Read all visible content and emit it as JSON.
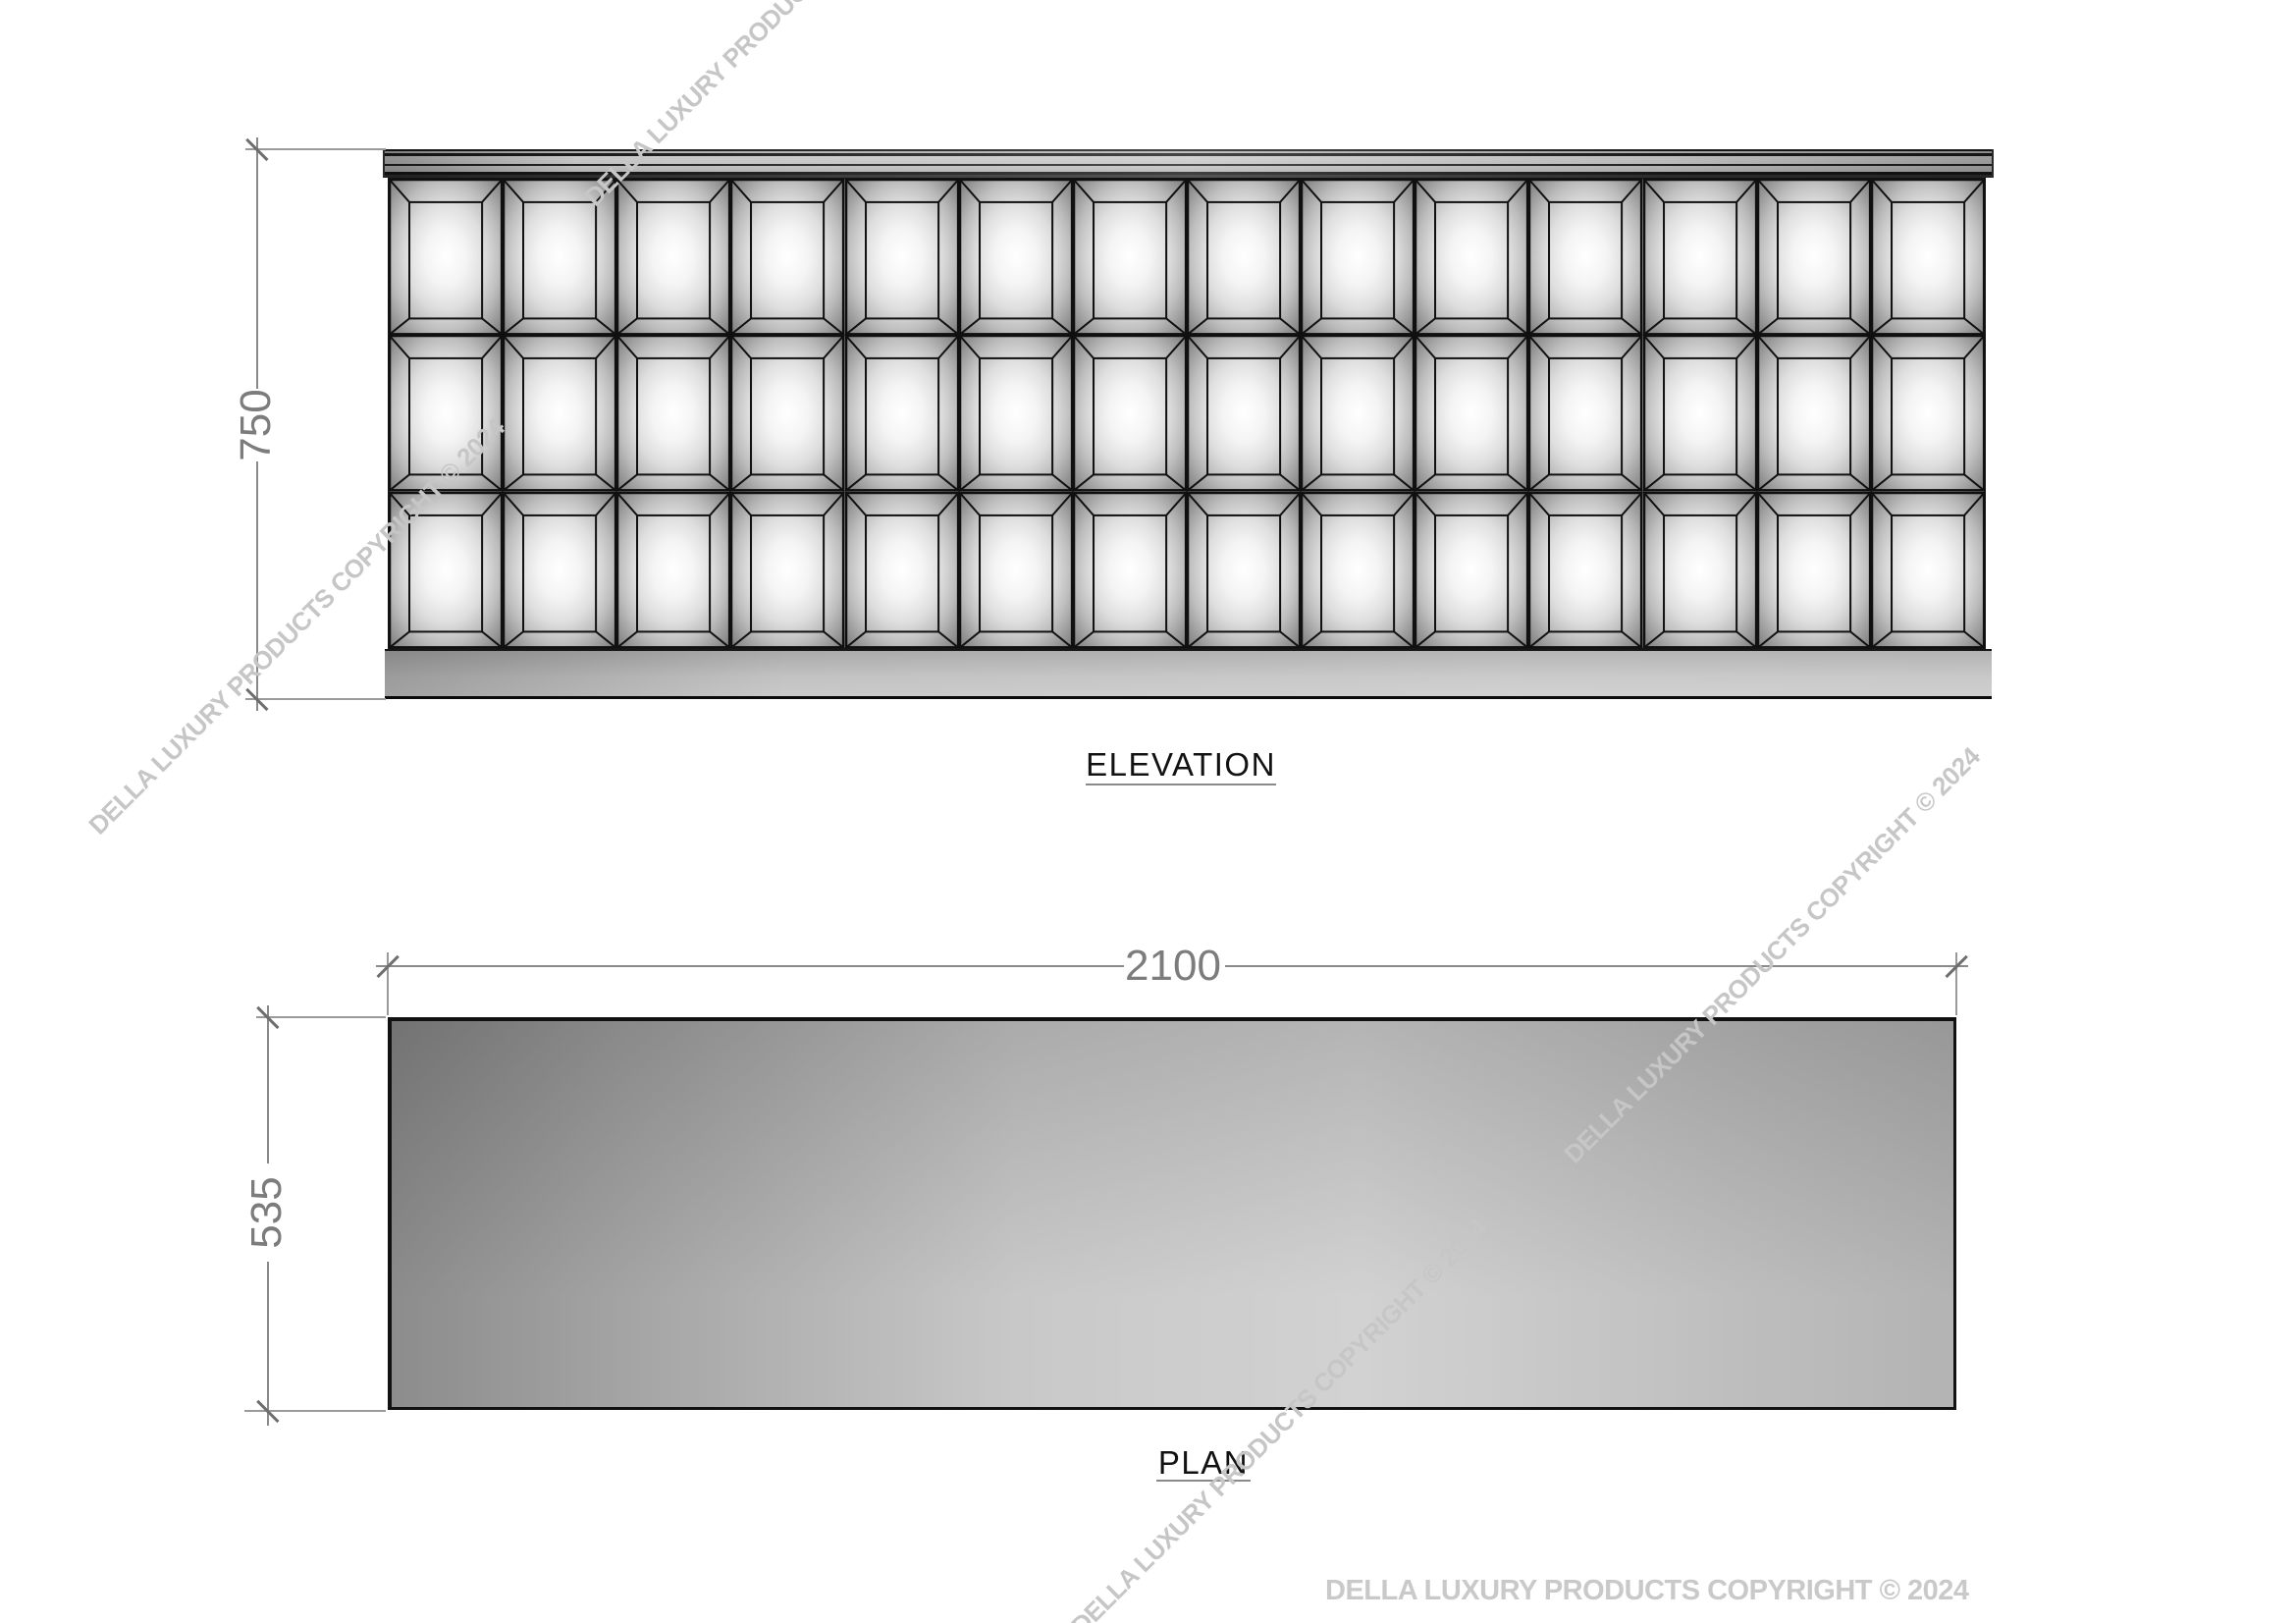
{
  "drawing": {
    "elevation": {
      "label": "ELEVATION",
      "height_dim": "750",
      "grid": {
        "rows": 3,
        "cols": 14
      }
    },
    "plan": {
      "label": "PLAN",
      "width_dim": "2100",
      "depth_dim": "535"
    },
    "watermark_text": "DELLA LUXURY PRODUCTS COPYRIGHT © 2024",
    "colors": {
      "line": "#111111",
      "dimension": "#7c7c7c",
      "watermark": "#c6c6c6",
      "panel_highlight": "#ffffff",
      "panel_shadow": "#787878"
    }
  }
}
